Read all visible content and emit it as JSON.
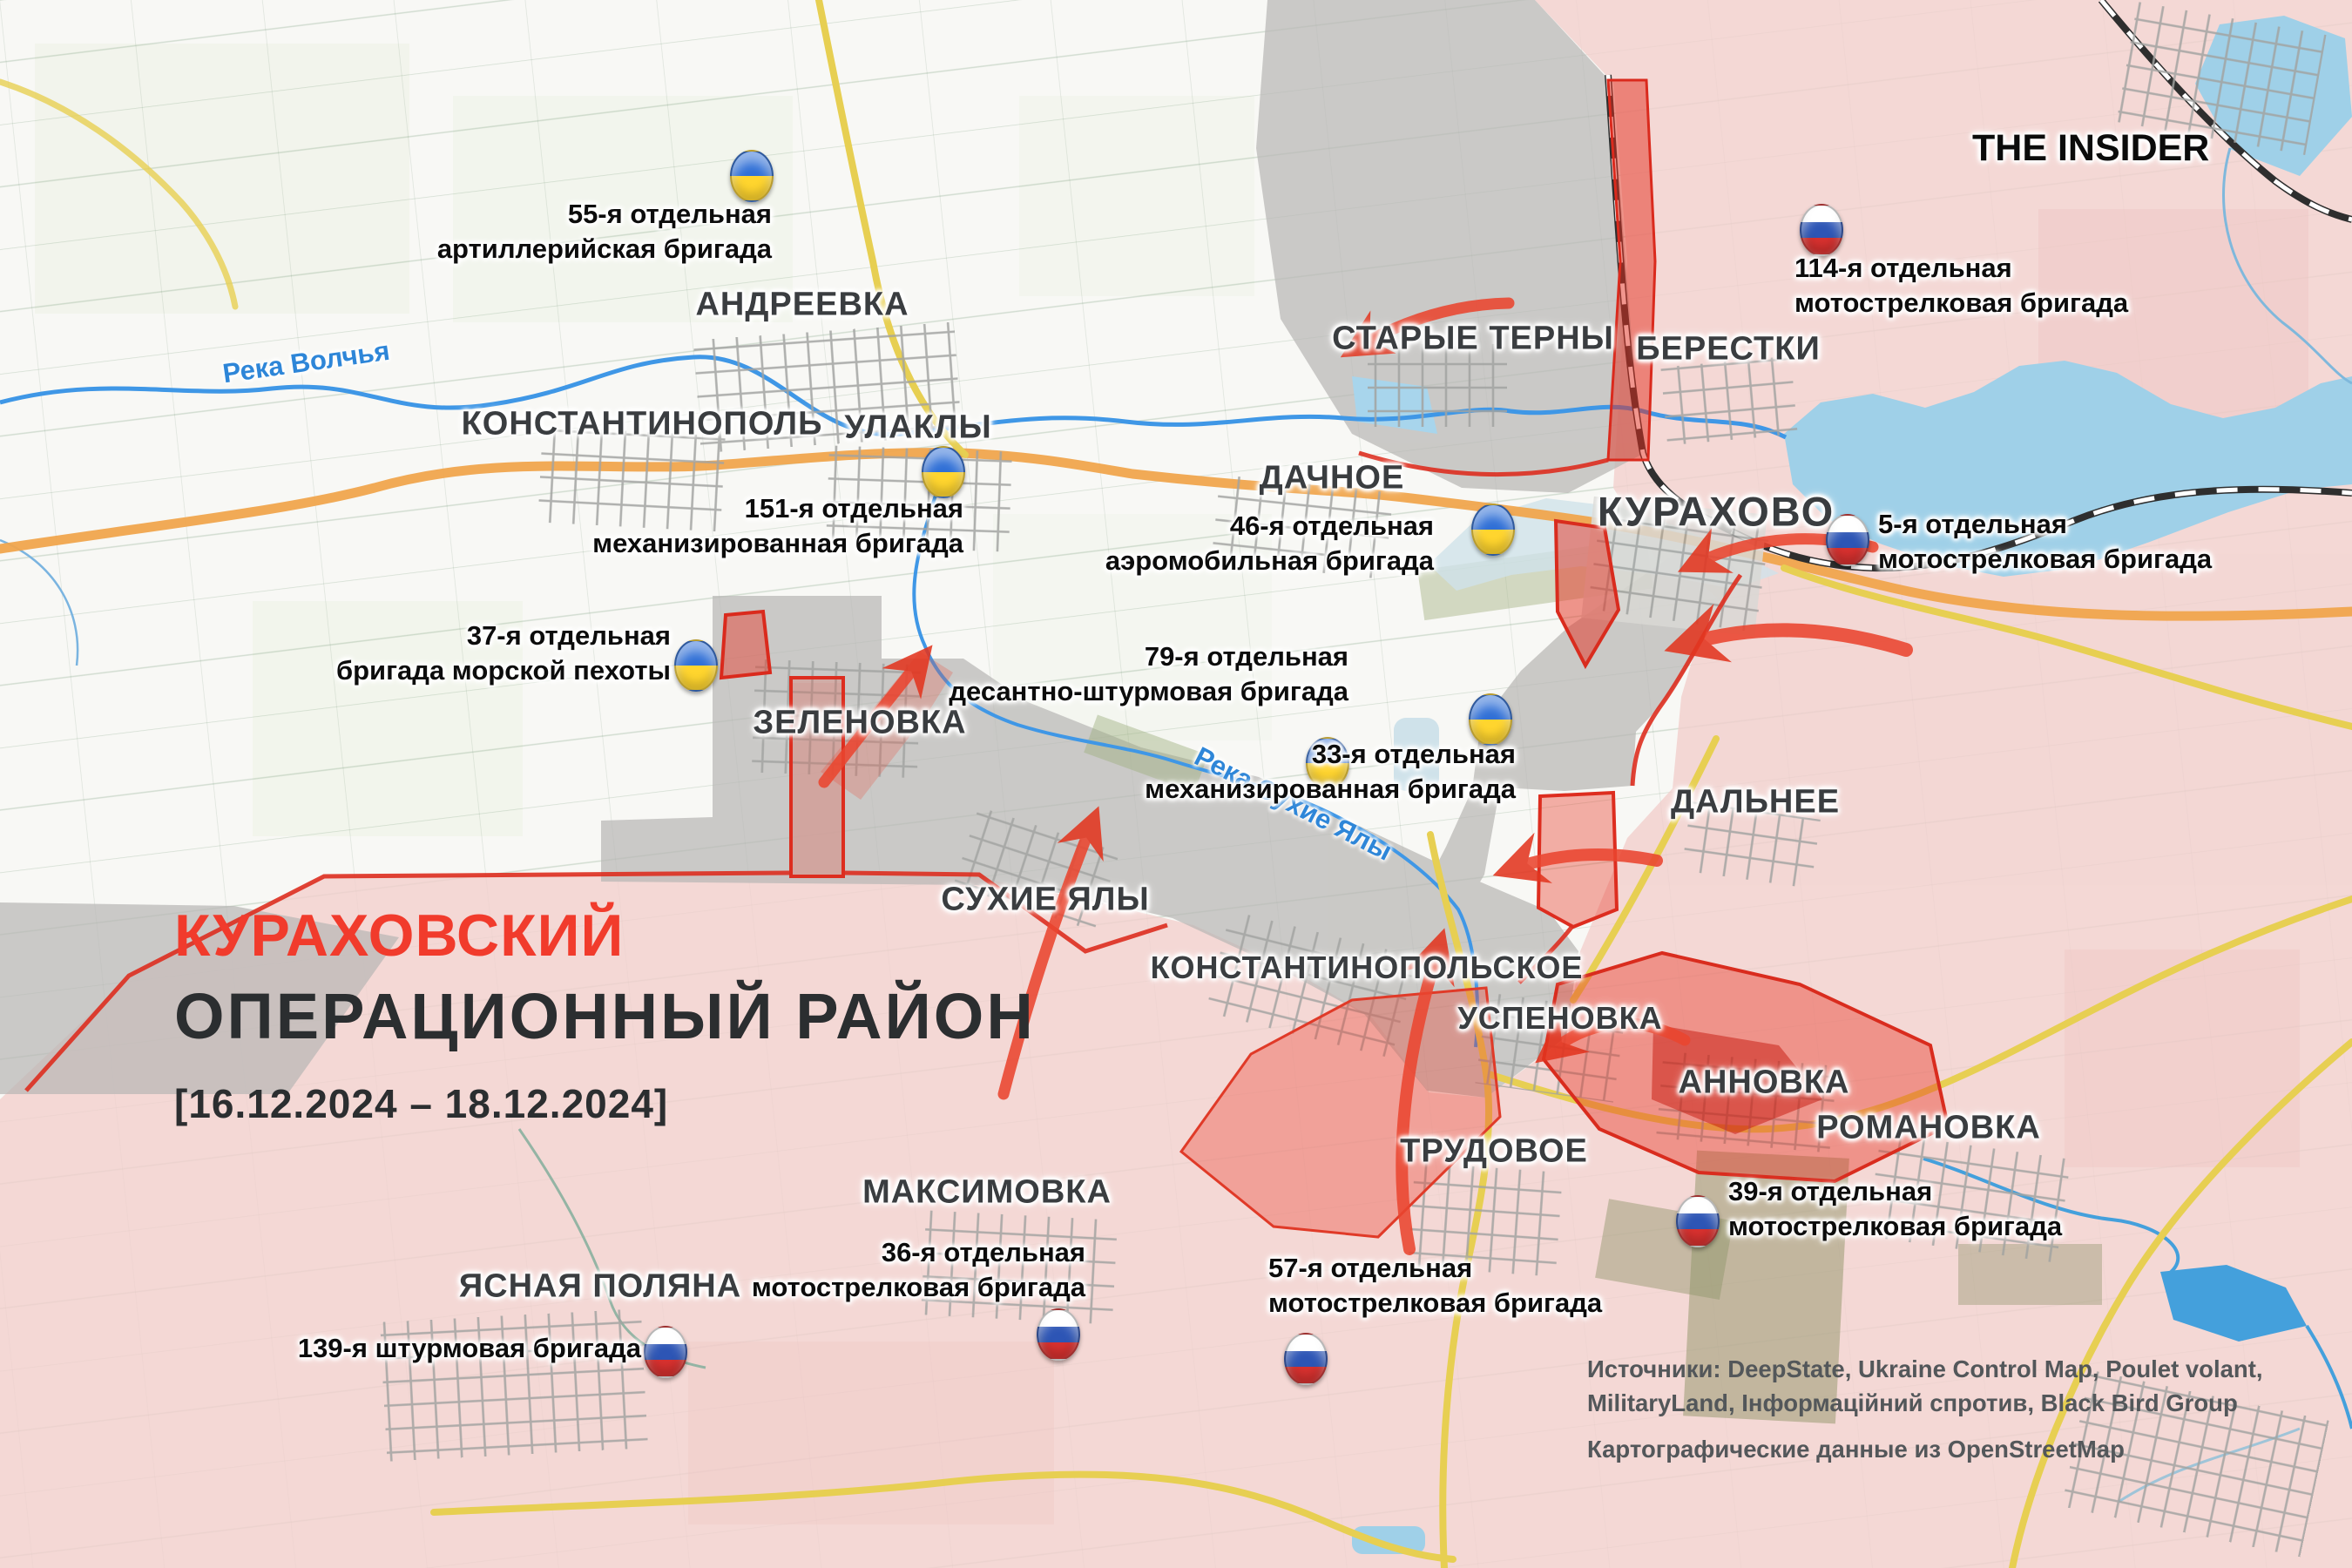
{
  "logo": {
    "text": "THE INSIDER"
  },
  "title": {
    "line1": "КУРАХОВСКИЙ",
    "line2": "ОПЕРАЦИОННЫЙ РАЙОН",
    "date": "[16.12.2024 – 18.12.2024]"
  },
  "sources": {
    "line1": "Источники: DeepState, Ukraine Control Map, Poulet volant,",
    "line2": "MilitaryLand, Інформаційний спротив, Black Bird Group",
    "line3": "Картографические данные из OpenStreetMap"
  },
  "rivers": [
    {
      "name": "Река Волчья"
    },
    {
      "name": "Река Сухие Ялы"
    }
  ],
  "settlements": [
    {
      "name": "АНДРЕЕВКА"
    },
    {
      "name": "КОНСТАНТИНОПОЛЬ"
    },
    {
      "name": "УЛАКЛЫ"
    },
    {
      "name": "СТАРЫЕ ТЕРНЫ"
    },
    {
      "name": "БЕРЕСТКИ"
    },
    {
      "name": "ДАЧНОЕ"
    },
    {
      "name": "КУРАХОВО"
    },
    {
      "name": "ЗЕЛЕНОВКА"
    },
    {
      "name": "СУХИЕ ЯЛЫ"
    },
    {
      "name": "КОНСТАНТИНОПОЛЬСКОЕ"
    },
    {
      "name": "УСПЕНОВКА"
    },
    {
      "name": "АННОВКА"
    },
    {
      "name": "РОМАНОВКА"
    },
    {
      "name": "ТРУДОВОЕ"
    },
    {
      "name": "ДАЛЬНЕЕ"
    },
    {
      "name": "МАКСИМОВКА"
    },
    {
      "name": "ЯСНАЯ ПОЛЯНА"
    }
  ],
  "units": [
    {
      "side": "ua",
      "flag": "ukraine-flag",
      "lines": [
        "55-я отдельная",
        "артиллерийская бригада"
      ]
    },
    {
      "side": "ua",
      "flag": "ukraine-flag",
      "lines": [
        "151-я отдельная",
        "механизированная бригада"
      ]
    },
    {
      "side": "ua",
      "flag": "ukraine-flag",
      "lines": [
        "46-я отдельная",
        "аэромобильная бригада"
      ]
    },
    {
      "side": "ua",
      "flag": "ukraine-flag",
      "lines": [
        "37-я отдельная",
        "бригада морской пехоты"
      ]
    },
    {
      "side": "ua",
      "flag": "ukraine-flag",
      "lines": [
        "79-я отдельная",
        "десантно-штурмовая бригада"
      ]
    },
    {
      "side": "ua",
      "flag": "ukraine-flag",
      "lines": [
        "33-я отдельная",
        "механизированная бригада"
      ]
    },
    {
      "side": "ru",
      "flag": "russia-flag",
      "lines": [
        "114-я отдельная",
        "мотострелковая бригада"
      ]
    },
    {
      "side": "ru",
      "flag": "russia-flag",
      "lines": [
        "5-я отдельная",
        "мотострелковая бригада"
      ]
    },
    {
      "side": "ru",
      "flag": "russia-flag",
      "lines": [
        "39-я отдельная",
        "мотострелковая бригада"
      ]
    },
    {
      "side": "ru",
      "flag": "russia-flag",
      "lines": [
        "36-я отдельная",
        "мотострелковая бригада"
      ]
    },
    {
      "side": "ru",
      "flag": "russia-flag",
      "lines": [
        "57-я отдельная",
        "мотострелковая бригада"
      ]
    },
    {
      "side": "ru",
      "flag": "russia-flag",
      "lines": [
        "139-я штурмовая бригада"
      ]
    }
  ],
  "colors": {
    "ukraine_held": "#f8f8f5",
    "russia_held": "#f2cfcd",
    "contested": "#b9b7b5",
    "recent_advance": "#e6392b",
    "title_red": "#f13b2c",
    "water": "#3f97e6",
    "road_major": "#f0a54d",
    "road_secondary": "#e5d14e"
  }
}
